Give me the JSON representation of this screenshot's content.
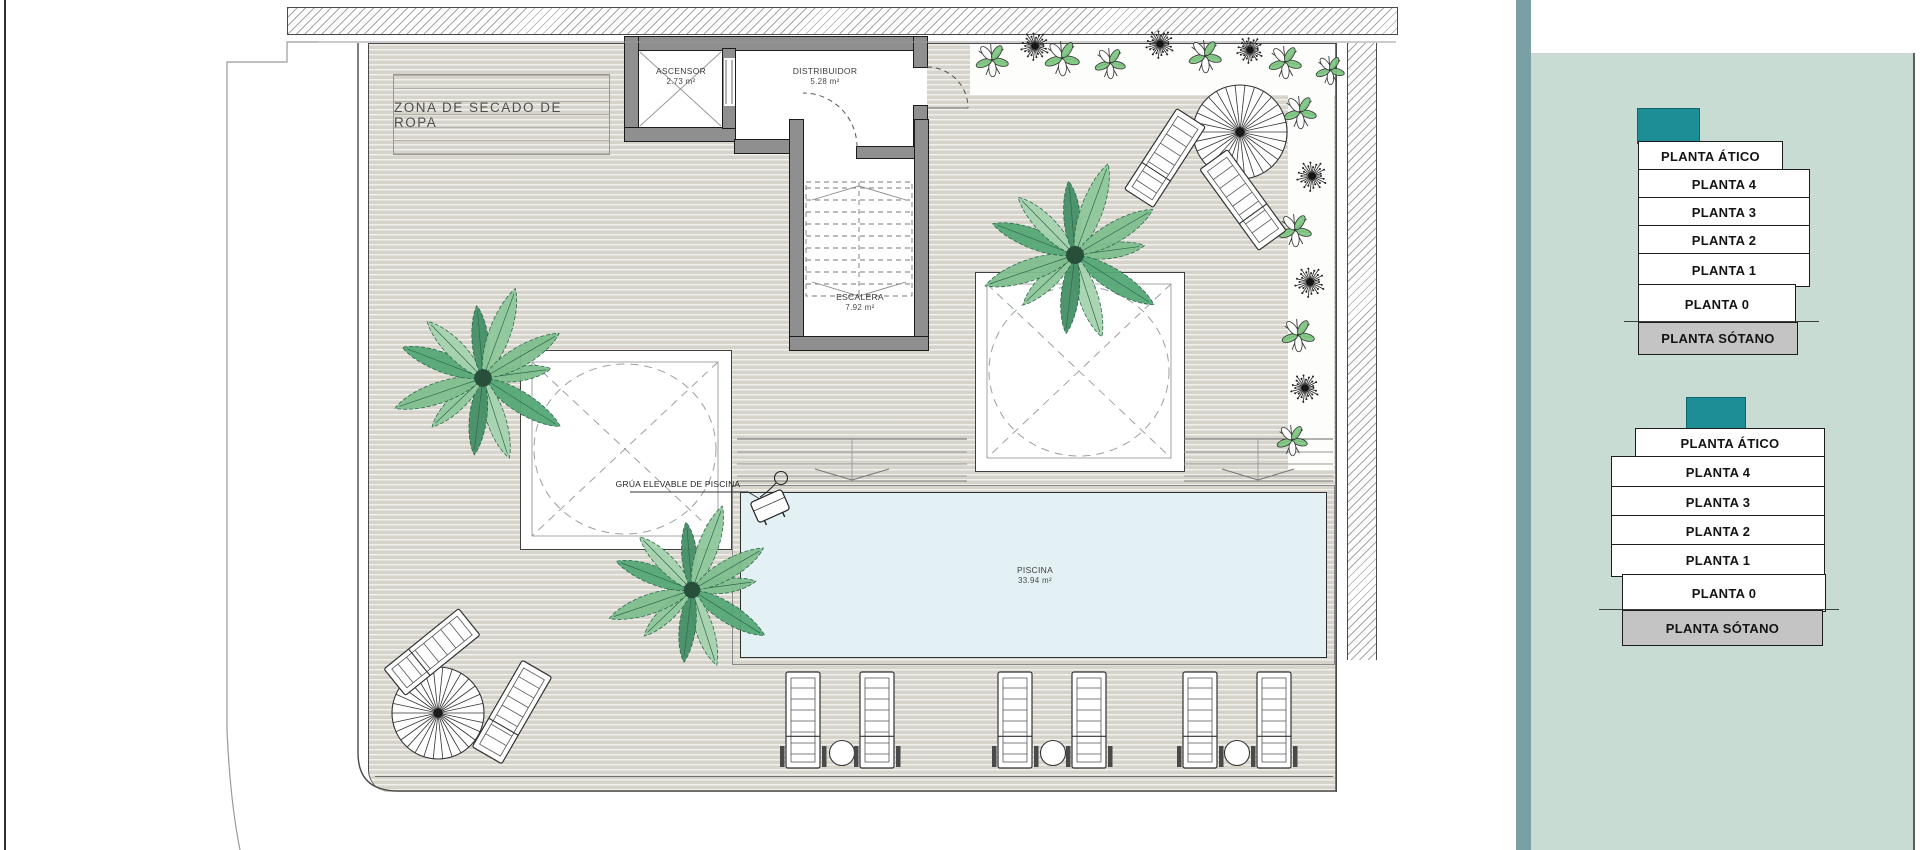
{
  "plan": {
    "drying_area_label": "ZONA DE SECADO DE ROPA",
    "rooms": {
      "ascensor": {
        "name": "ASCENSOR",
        "area": "2.73 m²"
      },
      "distribuidor": {
        "name": "DISTRIBUIDOR",
        "area": "5.28 m²"
      },
      "escalera": {
        "name": "ESCALERA",
        "area": "7.92 m²"
      },
      "piscina": {
        "name": "PISCINA",
        "area": "33.94 m²"
      }
    },
    "pool_lift_label": "GRÚA ELEVABLE DE PISCINA"
  },
  "sidebar": {
    "floor_selector_top": {
      "floors": [
        "PLANTA ÁTICO",
        "PLANTA 4",
        "PLANTA 3",
        "PLANTA 2",
        "PLANTA 1",
        "PLANTA 0",
        "PLANTA SÓTANO"
      ]
    },
    "floor_selector_bottom": {
      "floors": [
        "PLANTA ÁTICO",
        "PLANTA 4",
        "PLANTA 3",
        "PLANTA 2",
        "PLANTA 1",
        "PLANTA 0",
        "PLANTA SÓTANO"
      ]
    }
  },
  "colors": {
    "accent_teal": "#1e8e96",
    "sidebar_panel": "#c8dcd4",
    "sidebar_strip": "#7aa0a5",
    "pool_water": "#e4f1f4",
    "deck": "#d6d3ca",
    "wall": "#8f8f8f",
    "basement_button": "#c4c4c4"
  }
}
